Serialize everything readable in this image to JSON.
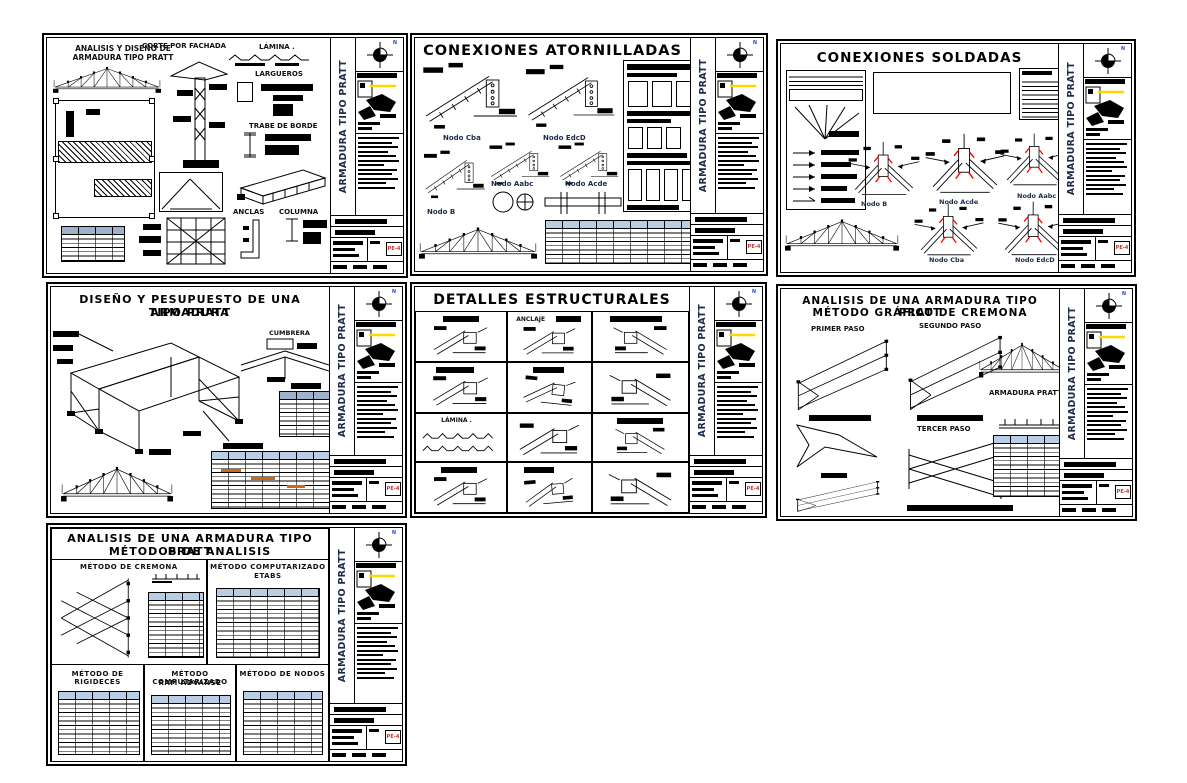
{
  "colors": {
    "ink": "#000000",
    "weld_mark_red": "#ff0000",
    "table_header_blue": "#b9cde5",
    "map_highlight_yellow": "#ffd800",
    "cad_text_navy": "#1c2a4a"
  },
  "titleblock": {
    "title": "ARMADURA TIPO PRATT",
    "north": "N",
    "code": "PE-4"
  },
  "s1": {
    "title_line1": "ANALISIS Y DISEÑO DE",
    "title_line2": "ARMADURA TIPO PRATT",
    "labels": {
      "corte": "CORTE POR FACHADA",
      "lamina": "LÁMINA .",
      "largueros": "LARGUEROS",
      "trabe": "TRABE DE BORDE",
      "anclas": "ANCLAS",
      "columna": "COLUMNA"
    }
  },
  "s2": {
    "title": "CONEXIONES ATORNILLADAS",
    "nodes": {
      "cba": "Nodo Cba",
      "edcd": "Nodo EdcD",
      "aabc": "Nodo Aabc",
      "acde": "Nodo Acde",
      "b": "Nodo B"
    }
  },
  "s3": {
    "title": "CONEXIONES SOLDADAS",
    "nodes": {
      "b": "Nodo B",
      "acde": "Nodo Acde",
      "aabc": "Nodo Aabc",
      "cba": "Nodo Cba",
      "edcd": "Nodo EdcD"
    }
  },
  "s4": {
    "title_line1": "DISEÑO Y PESUPUESTO DE UNA ARMADURA",
    "title_line2": "TIPO PRATT",
    "labels": {
      "cumbrera": "CUMBRERA"
    }
  },
  "s5": {
    "title": "DETALLES ESTRUCTURALES",
    "labels": {
      "anclaje": "ANCLAJE",
      "lamina": "LÁMINA ."
    }
  },
  "s6": {
    "title_line1": "ANALISIS DE UNA ARMADURA TIPO PRATT",
    "title_line2": "MÉTODO GRÁFICO DE CREMONA",
    "labels": {
      "paso1": "PRIMER PASO",
      "paso2": "SEGUNDO PASO",
      "paso3": "TERCER PASO",
      "armadura": "ARMADURA PRATT"
    }
  },
  "s7": {
    "title_line1": "ANALISIS DE UNA ARMADURA TIPO PRATT",
    "title_line2": "MÉTODOS DE ANALISIS",
    "sections": {
      "cremona": "MÉTODO DE CREMONA",
      "comp1": "MÉTODO COMPUTARIZADO",
      "etabs": "ETABS",
      "rigideces": "MÉTODO DE RIGIDECES",
      "comp2": "MÉTODO COMPUTARIZADO",
      "ram": "RAM ADVANSE",
      "nodos": "MÉTODO DE NODOS"
    }
  }
}
